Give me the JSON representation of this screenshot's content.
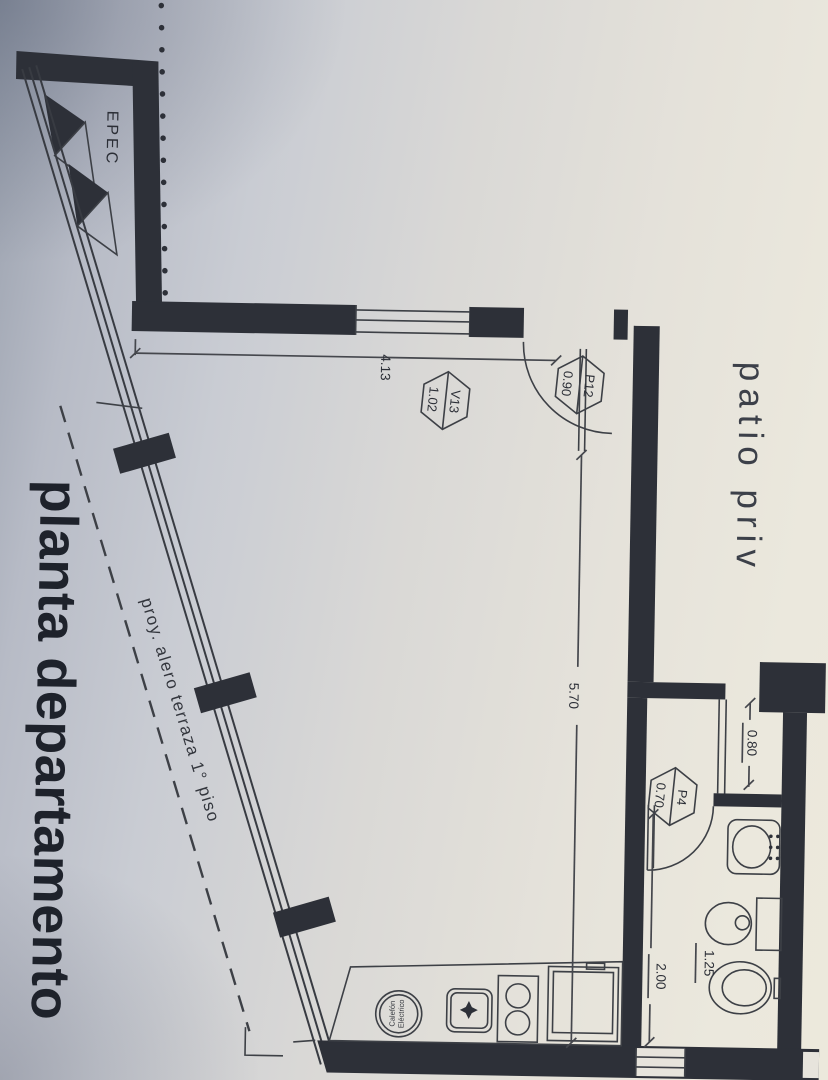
{
  "plan": {
    "title": "planta departamento",
    "areas": {
      "patio": "patio priv",
      "utility_closet": "EPEC"
    },
    "annotations": {
      "overhang": "proy. alero terraza 1° piso"
    },
    "appliances": {
      "heater_line1": "Calefón",
      "heater_line2": "Eléctrico"
    },
    "dimensions": {
      "room_width": "4.13",
      "room_length": "5.70",
      "bath_passage": "0.80",
      "bath_length": "2.00",
      "bath_width": "1.25"
    },
    "openings": [
      {
        "code": "V13",
        "size": "1.02"
      },
      {
        "code": "P12",
        "size": "0.90"
      },
      {
        "code": "P4",
        "size": "0.70"
      }
    ],
    "ink_color": "#2d3038"
  }
}
